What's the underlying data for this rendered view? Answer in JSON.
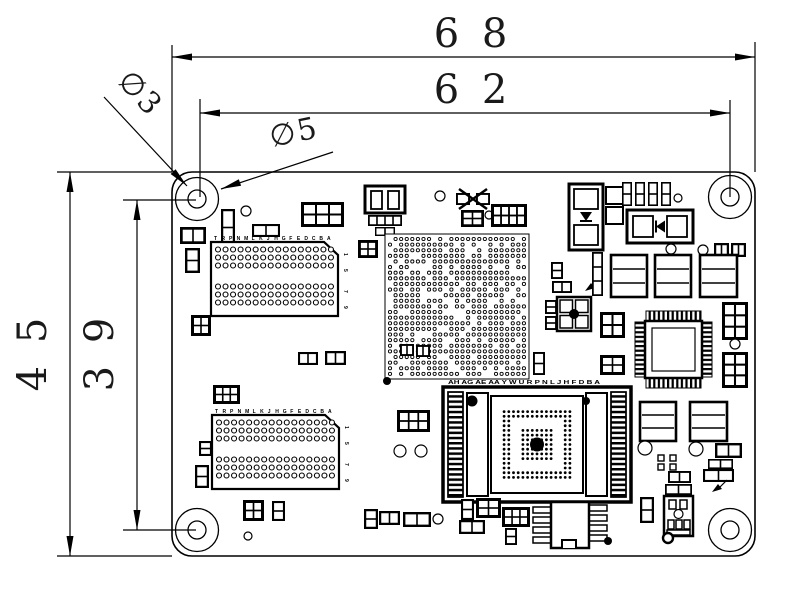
{
  "page": {
    "background": "#ffffff",
    "ink": "#000000"
  },
  "dimensions": {
    "top_outer": "6 8",
    "top_inner": "6 2",
    "left_outer": "4 5",
    "left_inner": "3 9",
    "hole_inner_dia": "∅3",
    "hole_outer_dia": "∅5"
  },
  "labels": {
    "connector_pins": "TRPNMLKJHGFEDCBA",
    "connector_rows": [
      "1",
      "5",
      "7",
      "9"
    ],
    "socket_pins": "AH AG AE AA Y W U R P N L J H F D B A"
  },
  "board": {
    "x": 172,
    "y": 172,
    "w": 583,
    "h": 384,
    "corner_radius": 20
  },
  "mounting_holes": [
    {
      "x": 197,
      "y": 199
    },
    {
      "x": 730,
      "y": 197
    },
    {
      "x": 197,
      "y": 530
    },
    {
      "x": 730,
      "y": 530
    }
  ],
  "components": [
    [
      "mount",
      197,
      199
    ],
    [
      "mount",
      730,
      197
    ],
    [
      "mount",
      197,
      530
    ],
    [
      "mount",
      730,
      530
    ],
    [
      "circle",
      246,
      211,
      5
    ],
    [
      "p2v",
      221,
      209,
      14,
      37
    ],
    [
      "p2h",
      252,
      224,
      28,
      13
    ],
    [
      "b32",
      301,
      202,
      43,
      25
    ],
    [
      "relay",
      365,
      186
    ],
    [
      "circle",
      440,
      196,
      5
    ],
    [
      "crystal",
      456,
      188,
      34,
      22
    ],
    [
      "b22",
      461,
      210,
      23,
      17
    ],
    [
      "circle",
      489,
      215,
      4
    ],
    [
      "b42",
      491,
      204,
      36,
      23
    ],
    [
      "diodeV",
      569,
      184,
      34,
      66
    ],
    [
      "sq",
      606,
      187,
      17,
      17
    ],
    [
      "sq",
      606,
      207,
      17,
      17
    ],
    [
      "capsRow",
      622,
      182
    ],
    [
      "circle",
      678,
      198,
      4
    ],
    [
      "diodeH",
      627,
      210,
      66,
      33
    ],
    [
      "circle",
      671,
      249,
      5
    ],
    [
      "circle",
      703,
      250,
      5
    ],
    [
      "p2h",
      714,
      243,
      15,
      14
    ],
    [
      "p2h",
      731,
      243,
      15,
      14
    ],
    [
      "cap",
      611,
      255,
      36,
      42
    ],
    [
      "cap",
      655,
      255,
      36,
      42
    ],
    [
      "cap",
      700,
      255,
      37,
      42
    ],
    [
      "b23",
      722,
      302,
      26,
      38
    ],
    [
      "circle",
      735,
      344,
      5
    ],
    [
      "b23",
      722,
      352,
      26,
      36
    ],
    [
      "qfp",
      634,
      310
    ],
    [
      "p2v",
      545,
      300,
      12,
      14
    ],
    [
      "p2v",
      545,
      316,
      12,
      14
    ],
    [
      "xdot",
      557,
      297,
      34,
      34
    ],
    [
      "b22",
      600,
      312,
      25,
      26
    ],
    [
      "b22",
      600,
      355,
      25,
      20
    ],
    [
      "p2v",
      551,
      262,
      12,
      17
    ],
    [
      "p2h",
      552,
      281,
      20,
      12
    ],
    [
      "larrow",
      585,
      291
    ],
    [
      "p3v",
      592,
      252,
      11,
      44
    ],
    [
      "p2v",
      533,
      352,
      12,
      23
    ],
    [
      "b22",
      358,
      240,
      20,
      18
    ],
    [
      "p2h",
      298,
      352,
      20,
      13
    ],
    [
      "p2h",
      325,
      351,
      21,
      14
    ],
    [
      "p2h",
      180,
      227,
      26,
      17
    ],
    [
      "p2v",
      185,
      248,
      15,
      25
    ],
    [
      "b22",
      191,
      315,
      20,
      21
    ],
    [
      "b32",
      213,
      385,
      27,
      19
    ],
    [
      "p2v",
      199,
      441,
      13,
      15
    ],
    [
      "eight",
      195,
      465,
      14,
      23
    ],
    [
      "b22",
      243,
      500,
      21,
      21
    ],
    [
      "p2v",
      272,
      501,
      13,
      20
    ],
    [
      "circle",
      248,
      536,
      4
    ],
    [
      "conn",
      211,
      242
    ],
    [
      "conn",
      212,
      415
    ],
    [
      "via",
      385,
      234,
      144,
      145
    ],
    [
      "dot",
      387,
      381,
      4
    ],
    [
      "b32",
      397,
      410,
      33,
      22
    ],
    [
      "circle",
      400,
      451,
      6
    ],
    [
      "circle",
      421,
      451,
      6
    ],
    [
      "p2h",
      400,
      344,
      14,
      12
    ],
    [
      "p2h",
      416,
      345,
      14,
      12
    ],
    [
      "socket",
      443,
      387
    ],
    [
      "cap",
      640,
      402,
      36,
      39
    ],
    [
      "cap",
      690,
      402,
      37,
      39
    ],
    [
      "circle",
      645,
      448,
      7
    ],
    [
      "circle",
      696,
      449,
      7
    ],
    [
      "sq4",
      658,
      455
    ],
    [
      "p2h",
      715,
      443,
      27,
      15
    ],
    [
      "p2h",
      708,
      459,
      25,
      10
    ],
    [
      "p2h",
      703,
      469,
      31,
      13
    ],
    [
      "larrow",
      712,
      492
    ],
    [
      "p2h",
      668,
      471,
      23,
      12
    ],
    [
      "p2h",
      665,
      484,
      27,
      11
    ],
    [
      "eight",
      640,
      497,
      14,
      26
    ],
    [
      "sot",
      664,
      496,
      29,
      40
    ],
    [
      "circleT",
      668,
      538,
      5
    ],
    [
      "eight",
      364,
      509,
      14,
      20
    ],
    [
      "p2h",
      379,
      511,
      21,
      14
    ],
    [
      "p2h",
      403,
      512,
      28,
      15
    ],
    [
      "circle",
      438,
      519,
      5
    ],
    [
      "p2v",
      461,
      499,
      13,
      21
    ],
    [
      "b22",
      476,
      498,
      25,
      20
    ],
    [
      "p2h",
      459,
      520,
      26,
      14
    ],
    [
      "b32",
      502,
      507,
      28,
      20
    ],
    [
      "p2v",
      505,
      528,
      12,
      17
    ],
    [
      "soic",
      533,
      500
    ],
    [
      "dot",
      608,
      541,
      4
    ]
  ]
}
